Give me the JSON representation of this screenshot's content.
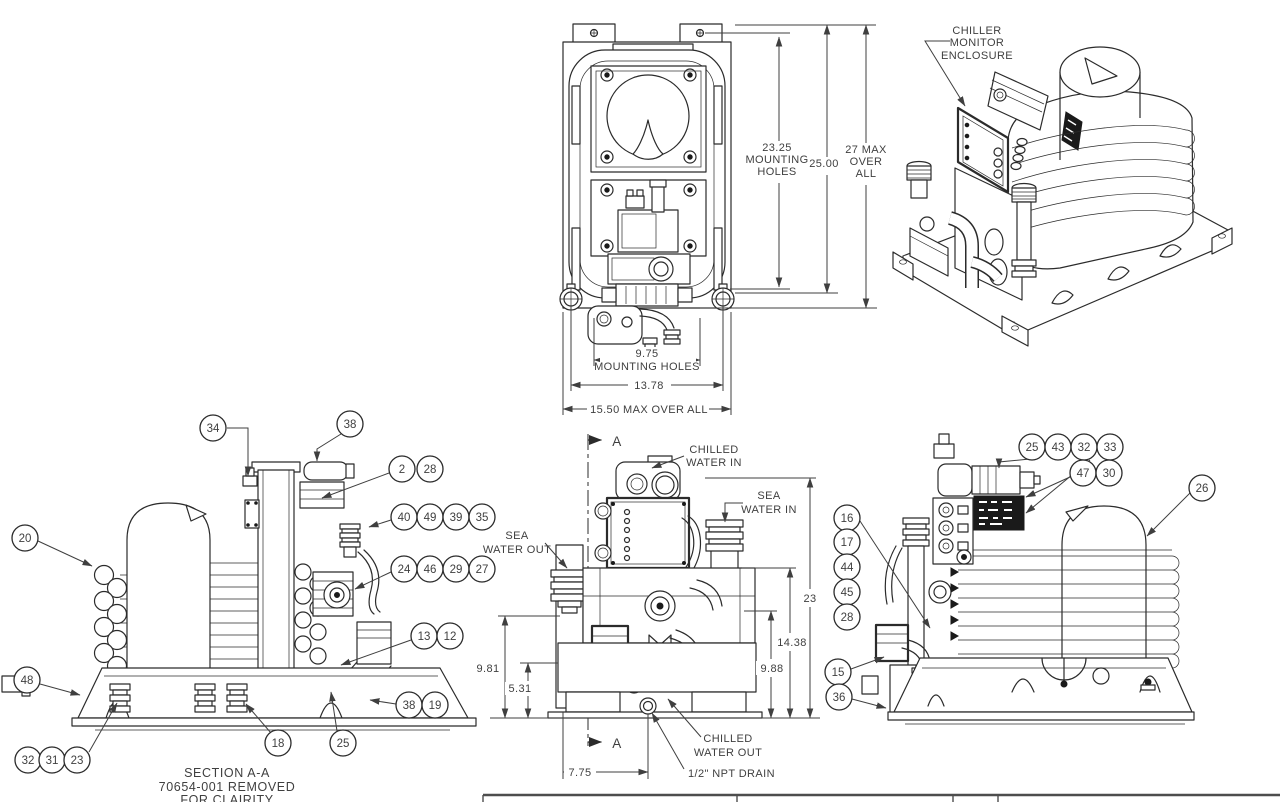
{
  "top_front_view": {
    "dim_mounting_height": {
      "l1": "23.25",
      "l2": "MOUNTING",
      "l3": "HOLES"
    },
    "dim_height": "25.00",
    "dim_overall_height": {
      "l1": "27 MAX",
      "l2": "OVER",
      "l3": "ALL"
    },
    "dim_mounting_width": {
      "l1": "9.75",
      "l2": "MOUNTING HOLES"
    },
    "dim_width": "13.78",
    "dim_overall_width": "15.50 MAX OVER ALL"
  },
  "iso_view": {
    "enclosure_label": {
      "l1": "CHILLER",
      "l2": "MONITOR",
      "l3": "ENCLOSURE"
    }
  },
  "left_view": {
    "note": {
      "l1": "SECTION A-A",
      "l2": "70654-001 REMOVED",
      "l3": "FOR CLAIRITY"
    },
    "balloons": [
      {
        "n": "34",
        "x": 213,
        "y": 428,
        "lead": "227,428 248,428 248,476"
      },
      {
        "n": "38",
        "x": 350,
        "y": 424,
        "lead": "341,434 317,449 317,461"
      },
      {
        "n": "2",
        "x": 402,
        "y": 469,
        "lead": "389,473 322,498"
      },
      {
        "n": "28",
        "x": 430,
        "y": 469
      },
      {
        "n": "40",
        "x": 404,
        "y": 517,
        "lead": "391,520 369,527"
      },
      {
        "n": "49",
        "x": 430,
        "y": 517
      },
      {
        "n": "39",
        "x": 456,
        "y": 517
      },
      {
        "n": "35",
        "x": 482,
        "y": 517
      },
      {
        "n": "24",
        "x": 404,
        "y": 569,
        "lead": "391,572 355,589"
      },
      {
        "n": "46",
        "x": 430,
        "y": 569
      },
      {
        "n": "29",
        "x": 456,
        "y": 569
      },
      {
        "n": "27",
        "x": 482,
        "y": 569
      },
      {
        "n": "13",
        "x": 424,
        "y": 636,
        "lead": "411,640 341,665"
      },
      {
        "n": "12",
        "x": 450,
        "y": 636
      },
      {
        "n": "38",
        "x": 409,
        "y": 705,
        "lead": "396,704 370,700"
      },
      {
        "n": "19",
        "x": 435,
        "y": 705
      },
      {
        "n": "18",
        "x": 278,
        "y": 743,
        "lead": "271,733 246,704"
      },
      {
        "n": "25",
        "x": 343,
        "y": 743,
        "lead": "337,731 331,692"
      },
      {
        "n": "20",
        "x": 25,
        "y": 538,
        "lead": "38,541 92,566"
      },
      {
        "n": "48",
        "x": 27,
        "y": 680,
        "lead": "40,684 80,695"
      },
      {
        "n": "32",
        "x": 28,
        "y": 760
      },
      {
        "n": "31",
        "x": 52,
        "y": 760
      },
      {
        "n": "23",
        "x": 77,
        "y": 760,
        "lead": "89,752 117,703"
      }
    ]
  },
  "center_view": {
    "section_label": "A",
    "labels": {
      "chilled_water_in": {
        "l1": "CHILLED",
        "l2": "WATER IN"
      },
      "sea_water_in": {
        "l1": "SEA",
        "l2": "WATER IN"
      },
      "sea_water_out": {
        "l1": "SEA",
        "l2": "WATER OUT"
      },
      "chilled_water_out": {
        "l1": "CHILLED",
        "l2": "WATER OUT"
      },
      "drain": "1/2\" NPT DRAIN"
    },
    "dims": {
      "overall": "23",
      "upper": "14.38",
      "right": "9.88",
      "left": "9.81",
      "left2": "5.31",
      "bottom": "7.75"
    }
  },
  "right_view": {
    "balloons": [
      {
        "n": "25",
        "x": 1032,
        "y": 447,
        "lead": "1030,459 999,462 999,468"
      },
      {
        "n": "43",
        "x": 1058,
        "y": 447
      },
      {
        "n": "32",
        "x": 1084,
        "y": 447,
        "lead": "1090,460 1026,513"
      },
      {
        "n": "33",
        "x": 1110,
        "y": 447
      },
      {
        "n": "47",
        "x": 1083,
        "y": 473,
        "lead": "1070,477 1026,497"
      },
      {
        "n": "30",
        "x": 1109,
        "y": 473
      },
      {
        "n": "26",
        "x": 1202,
        "y": 488,
        "lead": "1190,493 1147,536"
      },
      {
        "n": "16",
        "x": 847,
        "y": 518,
        "lead": "860,521 930,628"
      },
      {
        "n": "17",
        "x": 847,
        "y": 542
      },
      {
        "n": "44",
        "x": 847,
        "y": 567
      },
      {
        "n": "45",
        "x": 847,
        "y": 592
      },
      {
        "n": "28",
        "x": 847,
        "y": 617
      },
      {
        "n": "15",
        "x": 838,
        "y": 672,
        "lead": "851,669 884,657"
      },
      {
        "n": "36",
        "x": 839,
        "y": 697,
        "lead": "852,699 886,708"
      }
    ]
  }
}
